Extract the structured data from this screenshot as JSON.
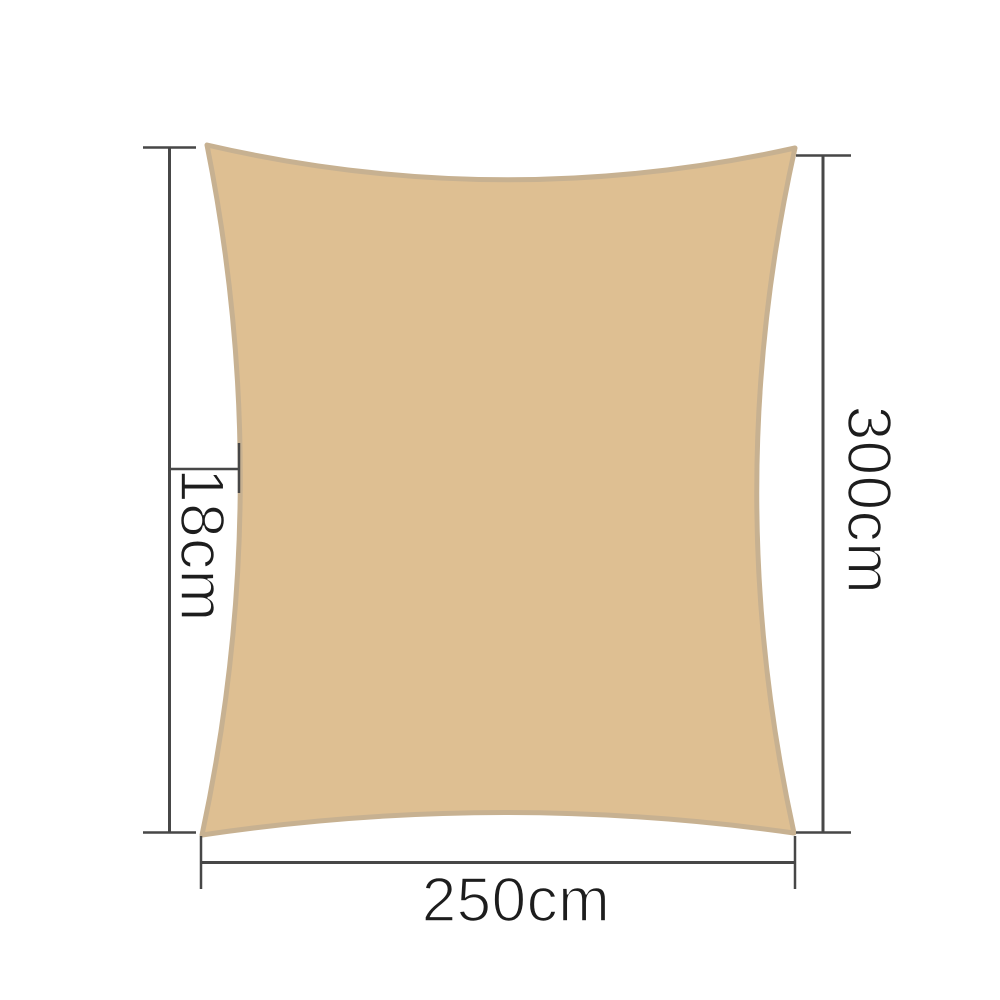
{
  "diagram": {
    "title": "shade sail rectangle dimension diagram",
    "width_label": "250cm",
    "height_label": "300cm",
    "sag_label": "18cm",
    "colors": {
      "sail_fill": "#debf92",
      "sail_hem": "#c7b191",
      "dimension_line": "#474747",
      "label_text": "#1d1d1d",
      "background": "#ffffff"
    }
  }
}
